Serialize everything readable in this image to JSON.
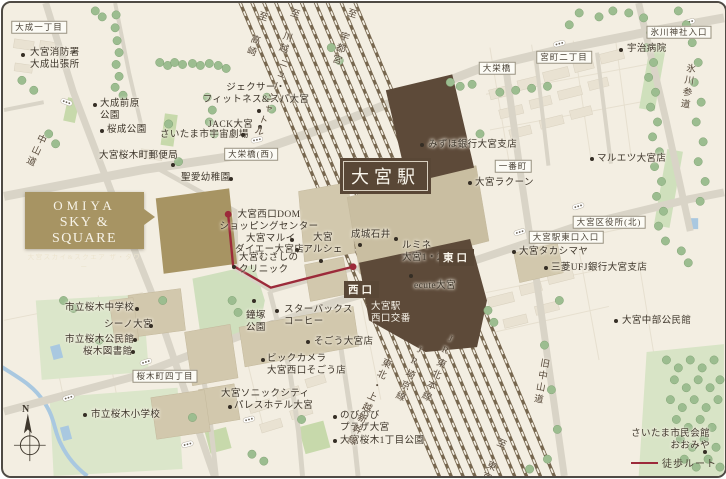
{
  "logo": {
    "en1": "OMIYA",
    "en2": "SKY & SQUARE",
    "jp": "大宮スカイ&スクエア ザ・タワー"
  },
  "station": {
    "label": "大宮駅"
  },
  "exits": [
    {
      "id": "west",
      "text": "西口",
      "x": 341,
      "y": 278
    },
    {
      "id": "east",
      "text": "東口",
      "x": 436,
      "y": 246
    }
  ],
  "legend": {
    "route_label": "徒歩ルート"
  },
  "compass": {
    "north_label": "N"
  },
  "colors": {
    "background": "#f3eee2",
    "road": "#d9d4c7",
    "railway": "#77674f",
    "station_dark": "#5d4a39",
    "building_tan": "#d2c8ad",
    "landmark_gold": "#a79463",
    "tree": "#9cbd90",
    "park": "#d8e4c6",
    "water": "#a9c8e0",
    "route_red": "#9c2a3a",
    "text": "#433b2f"
  },
  "area_labels": [
    {
      "id": "taisei-1chome",
      "text": "大成一丁目",
      "x": 36,
      "y": 24
    },
    {
      "id": "daieibashi-west",
      "text": "大栄橋(西)",
      "x": 248,
      "y": 151
    },
    {
      "id": "daieibashi",
      "text": "大栄橋",
      "x": 494,
      "y": 65
    },
    {
      "id": "miyacho-2chome",
      "text": "宮町二丁目",
      "x": 561,
      "y": 54
    },
    {
      "id": "hikawa-jinja-iriguchi",
      "text": "氷川神社入口",
      "x": 676,
      "y": 29
    },
    {
      "id": "ichibancho",
      "text": "一番町",
      "x": 510,
      "y": 163
    },
    {
      "id": "ward-office-north",
      "text": "大宮区役所(北)",
      "x": 606,
      "y": 219
    },
    {
      "id": "higashiguchi-iriguchi",
      "text": "大宮駅東口入口",
      "x": 563,
      "y": 234
    },
    {
      "id": "sakuragicho-4chome",
      "text": "桜木町四丁目",
      "x": 162,
      "y": 373
    }
  ],
  "poi_labels": [
    {
      "id": "fire-station",
      "lines": [
        "大宮消防署",
        "大成出張所"
      ],
      "x": 27,
      "y": 45,
      "dot": [
        20,
        52
      ],
      "anchor": "left"
    },
    {
      "id": "maehara-park",
      "lines": [
        "大成前原",
        "公園"
      ],
      "x": 97,
      "y": 96,
      "dot": [
        92,
        102
      ],
      "anchor": "left"
    },
    {
      "id": "sakuranari-park",
      "lines": [
        "桜成公園"
      ],
      "x": 104,
      "y": 122,
      "dot": [
        99,
        128
      ],
      "anchor": "left"
    },
    {
      "id": "post-office",
      "lines": [
        "大宮桜木町郵便局"
      ],
      "x": 96,
      "y": 148,
      "dot": [
        170,
        162
      ],
      "anchor": "left"
    },
    {
      "id": "jexer",
      "lines": [
        "ジェクサー・",
        "フィットネス&スパ大宮"
      ],
      "x": 253,
      "y": 80,
      "dot": [
        256,
        108
      ],
      "anchor": "center"
    },
    {
      "id": "jack-omiya",
      "lines": [
        "JACK大宮"
      ],
      "x": 205,
      "y": 117,
      "dot": [
        257,
        124
      ],
      "anchor": "left"
    },
    {
      "id": "space-theater",
      "lines": [
        "さいたま市宇宙劇場"
      ],
      "x": 157,
      "y": 127,
      "dot": [
        240,
        132
      ],
      "anchor": "left"
    },
    {
      "id": "seiai-kindergarten",
      "lines": [
        "聖愛幼稚園"
      ],
      "x": 178,
      "y": 170,
      "dot": [
        228,
        176
      ],
      "anchor": "left"
    },
    {
      "id": "dom-shopping",
      "lines": [
        "大宮西口DOM",
        "ショッピングセンター"
      ],
      "x": 266,
      "y": 207,
      "dot": null,
      "anchor": "center"
    },
    {
      "id": "marui",
      "lines": [
        "大宮マルイ"
      ],
      "x": 243,
      "y": 231,
      "dot": [
        289,
        237
      ],
      "anchor": "left"
    },
    {
      "id": "daiei",
      "lines": [
        "ダイエー大宮店"
      ],
      "x": 232,
      "y": 242,
      "dot": [
        294,
        247
      ],
      "anchor": "left"
    },
    {
      "id": "arche",
      "lines": [
        "大宮",
        "アルシェ"
      ],
      "x": 320,
      "y": 230,
      "dot": [
        318,
        258
      ],
      "anchor": "center"
    },
    {
      "id": "musashino-clinic",
      "lines": [
        "大宮むさしの",
        "クリニック"
      ],
      "x": 236,
      "y": 250,
      "dot": [
        231,
        264
      ],
      "anchor": "left"
    },
    {
      "id": "seijo-ishii",
      "lines": [
        "成城石井"
      ],
      "x": 348,
      "y": 227,
      "dot": [
        357,
        242
      ],
      "anchor": "left"
    },
    {
      "id": "lumine",
      "lines": [
        "ルミネ",
        "大宮1・2"
      ],
      "x": 399,
      "y": 238,
      "dot": [
        393,
        236
      ],
      "anchor": "left"
    },
    {
      "id": "ecute",
      "lines": [
        "ecute大宮"
      ],
      "x": 411,
      "y": 278,
      "dot": [
        408,
        273
      ],
      "anchor": "left"
    },
    {
      "id": "nishiguchi-koban",
      "lines": [
        "大宮駅",
        "西口交番"
      ],
      "x": 368,
      "y": 299,
      "dot": null,
      "anchor": "left",
      "light": true
    },
    {
      "id": "starbucks",
      "lines": [
        "スターバックス",
        "コーヒー"
      ],
      "x": 281,
      "y": 302,
      "dot": [
        274,
        308
      ],
      "anchor": "left"
    },
    {
      "id": "kanetsuka-park",
      "lines": [
        "鐘塚",
        "公園"
      ],
      "x": 243,
      "y": 308,
      "dot": [
        251,
        298
      ],
      "anchor": "left"
    },
    {
      "id": "sogo",
      "lines": [
        "そごう大宮店"
      ],
      "x": 311,
      "y": 334,
      "dot": [
        305,
        339
      ],
      "anchor": "left"
    },
    {
      "id": "biccamera",
      "lines": [
        "ビックカメラ",
        "大宮西口そごう店"
      ],
      "x": 264,
      "y": 351,
      "dot": [
        260,
        357
      ],
      "anchor": "left"
    },
    {
      "id": "sonic-city",
      "lines": [
        "大宮ソニックシティ"
      ],
      "x": 218,
      "y": 386,
      "dot": null,
      "anchor": "left"
    },
    {
      "id": "palace-hotel",
      "lines": [
        "パレスホテル大宮"
      ],
      "x": 231,
      "y": 398,
      "dot": [
        227,
        404
      ],
      "anchor": "left"
    },
    {
      "id": "nobinobi-plaza",
      "lines": [
        "のびのび",
        "プラザ大宮"
      ],
      "x": 337,
      "y": 408,
      "dot": [
        332,
        414
      ],
      "anchor": "left"
    },
    {
      "id": "sakuragi-1chome-park",
      "lines": [
        "大宮桜木1丁目公園"
      ],
      "x": 337,
      "y": 433,
      "dot": [
        332,
        438
      ],
      "anchor": "left"
    },
    {
      "id": "sakuragi-junior-high",
      "lines": [
        "市立桜木中学校"
      ],
      "x": 62,
      "y": 300,
      "dot": [
        134,
        306
      ],
      "anchor": "left"
    },
    {
      "id": "shino-omiya",
      "lines": [
        "シーノ大宮"
      ],
      "x": 101,
      "y": 317,
      "dot": [
        148,
        323
      ],
      "anchor": "left"
    },
    {
      "id": "sakuragi-community-hall",
      "lines": [
        "市立桜木公民館"
      ],
      "x": 62,
      "y": 332,
      "dot": [
        132,
        337
      ],
      "anchor": "left"
    },
    {
      "id": "sakuragi-library",
      "lines": [
        "桜木図書館"
      ],
      "x": 80,
      "y": 344,
      "dot": [
        130,
        349
      ],
      "anchor": "left"
    },
    {
      "id": "sakuragi-elementary",
      "lines": [
        "市立桜木小学校"
      ],
      "x": 88,
      "y": 407,
      "dot": [
        82,
        412
      ],
      "anchor": "left"
    },
    {
      "id": "mizuho-bank",
      "lines": [
        "みずほ銀行大宮支店"
      ],
      "x": 425,
      "y": 137,
      "dot": [
        419,
        142
      ],
      "anchor": "left"
    },
    {
      "id": "uji-hospital",
      "lines": [
        "宇治病院"
      ],
      "x": 624,
      "y": 41,
      "dot": [
        618,
        47
      ],
      "anchor": "left"
    },
    {
      "id": "maruetsu",
      "lines": [
        "マルエツ大宮店"
      ],
      "x": 594,
      "y": 151,
      "dot": [
        589,
        156
      ],
      "anchor": "left"
    },
    {
      "id": "racoon",
      "lines": [
        "大宮ラクーン"
      ],
      "x": 472,
      "y": 175,
      "dot": [
        467,
        180
      ],
      "anchor": "left"
    },
    {
      "id": "takashimaya",
      "lines": [
        "大宮タカシマヤ"
      ],
      "x": 516,
      "y": 244,
      "dot": [
        511,
        249
      ],
      "anchor": "left"
    },
    {
      "id": "mufg-bank",
      "lines": [
        "三菱UFJ銀行大宮支店"
      ],
      "x": 548,
      "y": 260,
      "dot": [
        543,
        265
      ],
      "anchor": "left"
    },
    {
      "id": "chubu-community-hall",
      "lines": [
        "大宮中部公民館"
      ],
      "x": 619,
      "y": 313,
      "dot": [
        613,
        318
      ],
      "anchor": "left"
    },
    {
      "id": "saitama-civic-hall",
      "lines": [
        "さいたま市民会館",
        "おおみや"
      ],
      "x": 711,
      "y": 426,
      "dot": [
        702,
        449
      ],
      "anchor": "right"
    }
  ],
  "rail_labels": [
    {
      "id": "to-takasaki",
      "text": "至 高崎",
      "x": 260,
      "y": 8,
      "rot": 18
    },
    {
      "id": "to-kawagoe",
      "text": "至 川越",
      "x": 292,
      "y": 5,
      "rot": 18
    },
    {
      "id": "new-shuttle",
      "text": "ニューシャトル",
      "x": 281,
      "y": 55,
      "rot": 20
    },
    {
      "id": "to-utsunomiya",
      "text": "至 宇都宮",
      "x": 349,
      "y": 5,
      "rot": 18
    },
    {
      "id": "shinkansen",
      "text": "東北・上越新幹線",
      "x": 384,
      "y": 355,
      "rot": 24
    },
    {
      "id": "jr-saikyo-line",
      "text": "JR埼京線",
      "x": 418,
      "y": 343,
      "rot": 24
    },
    {
      "id": "jr-tohoku-line",
      "text": "JR東北本線",
      "x": 449,
      "y": 332,
      "rot": 24
    },
    {
      "id": "to-tokyo",
      "text": "至 東京",
      "x": 499,
      "y": 435,
      "rot": 24
    }
  ],
  "road_labels": [
    {
      "id": "nakasendo",
      "text": "中山道",
      "x": 39,
      "y": 131,
      "rot": 25
    },
    {
      "id": "hikawa-sando",
      "text": "氷川参道",
      "x": 687,
      "y": 60,
      "rot": 9
    },
    {
      "id": "kyu-nakasendo",
      "text": "旧中山道",
      "x": 541,
      "y": 355,
      "rot": 10
    }
  ]
}
